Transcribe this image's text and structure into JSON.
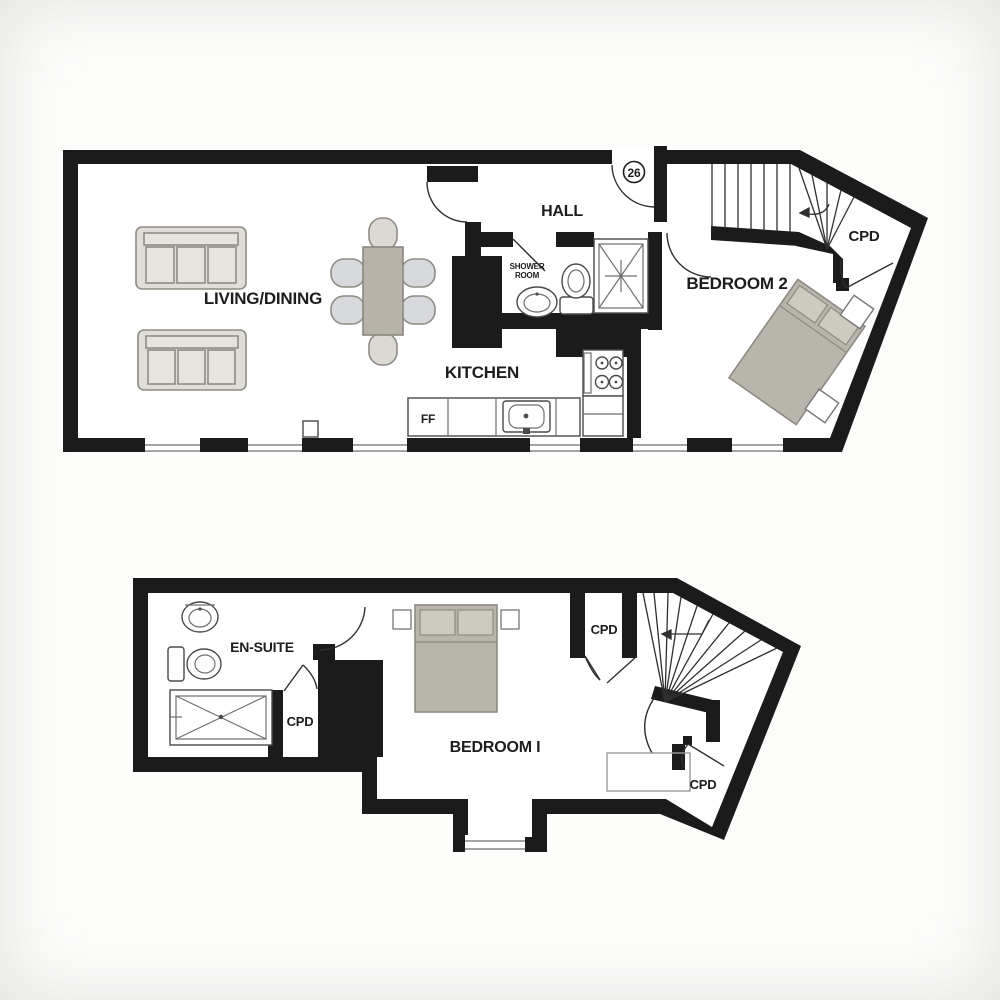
{
  "plan": {
    "type": "two-storey apartment floor plan",
    "colors": {
      "wall": "#1b1b1b",
      "floor": "#ffffff",
      "furniture_gray": "#b7b3ab",
      "pillow_gray": "#cdcac2",
      "sofa_gray": "#e0ded8",
      "chair_gray": "#d7d9dc",
      "line_gray": "#6e6e6e"
    }
  },
  "upper_floor": {
    "living_dining_label": "LIVING/DINING",
    "kitchen_label": "KITCHEN",
    "hall_label": "HALL",
    "shower_room_label_line1": "SHOWER",
    "shower_room_label_line2": "ROOM",
    "bedroom2_label": "BEDROOM 2",
    "cupboard_label": "CPD",
    "fridge_freezer_label": "FF",
    "unit_number": "26"
  },
  "lower_floor": {
    "ensuite_label": "EN-SUITE",
    "bedroom1_label": "BEDROOM I",
    "cupboard_left_label": "CPD",
    "cupboard_top_label": "CPD",
    "cupboard_bottom_label": "CPD"
  }
}
